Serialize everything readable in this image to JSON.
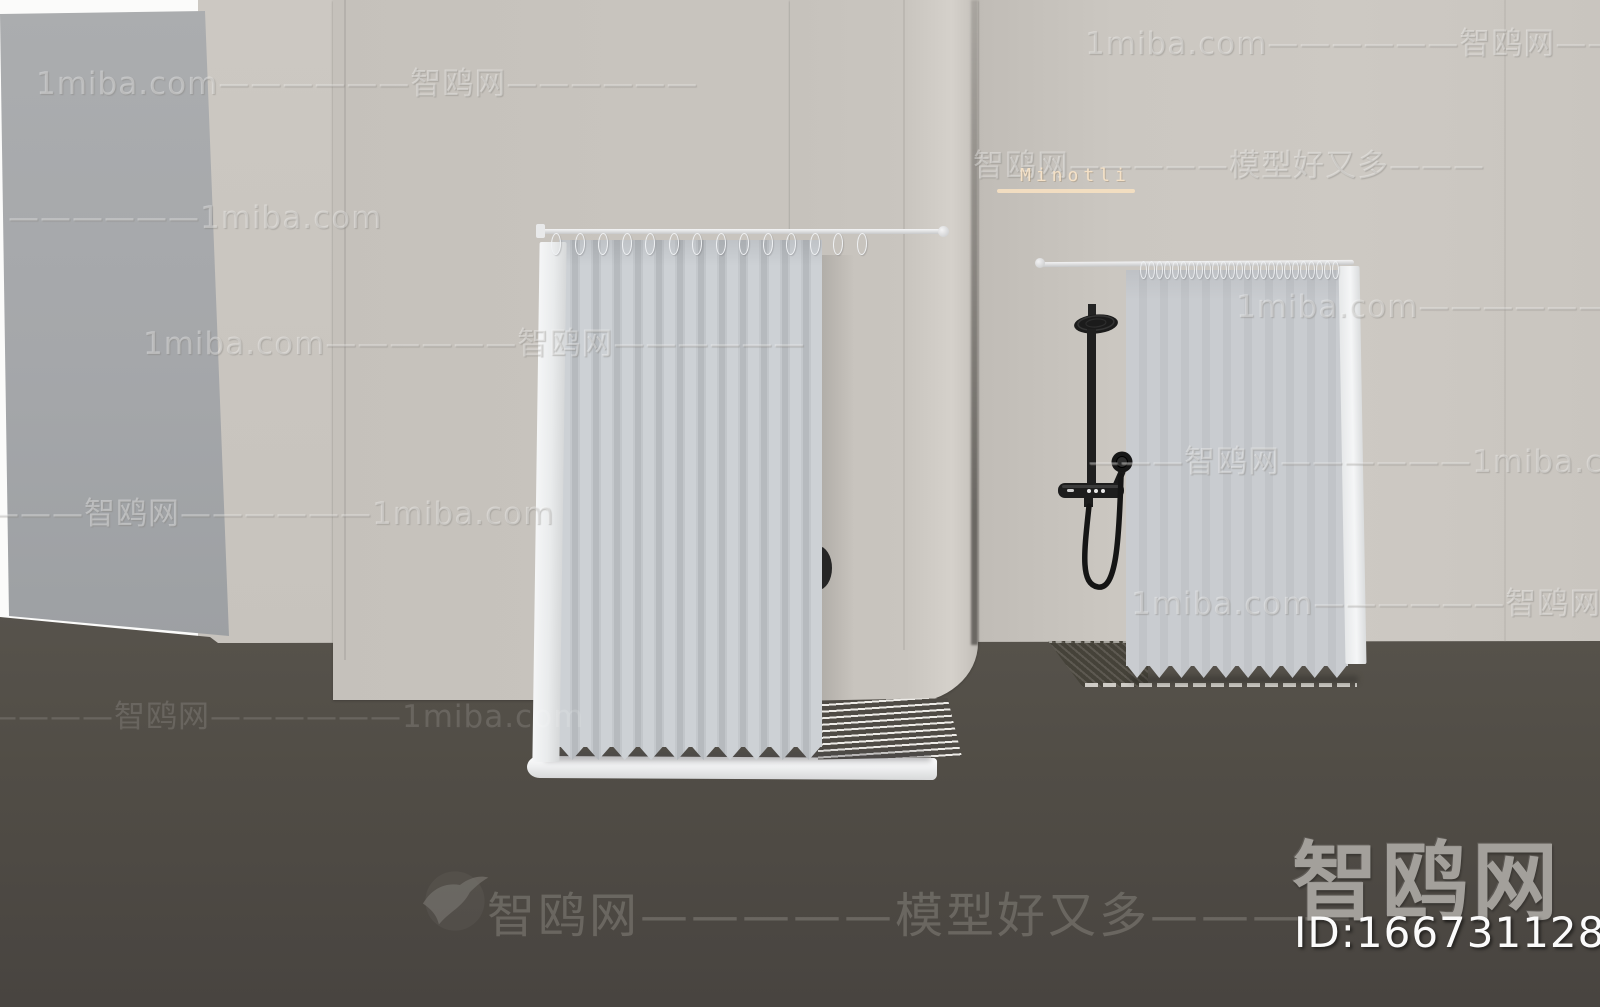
{
  "watermark_rows": [
    {
      "text": "1miba.com——————智鸥网———"
    },
    {
      "text": "1miba.com——————智鸥网——————"
    },
    {
      "text": "智鸥网—————模型好又多———"
    },
    {
      "text": "——————1miba.com"
    },
    {
      "text": "1miba.com——————智鸥网——"
    },
    {
      "text": "1miba.com——————智鸥网——————"
    },
    {
      "text": "———智鸥网——————1miba.com———"
    },
    {
      "text": "————智鸥网——————1miba.com"
    },
    {
      "text": "1miba.com——————智鸥网———"
    },
    {
      "text": "——————智鸥网——————1miba.com"
    }
  ],
  "floor_watermark": {
    "text": "智鸥网—————模型好又多————"
  },
  "brand_label": {
    "text": "Minotli"
  },
  "site_logo": {
    "name": "智鸥网",
    "model_id": "ID:166731128"
  },
  "colors": {
    "wall": "#c8c4be",
    "left_panel": "#a5a7aa",
    "floor": "#514d46",
    "curtain": "#c6cacd",
    "curtain_edge_white": "#f5f6f7",
    "fixture_black": "#1d1d1d",
    "brand_label_accent": "#f4e1c7",
    "logo_gray": "#a3a09b",
    "id_white": "#fbfbfb"
  }
}
